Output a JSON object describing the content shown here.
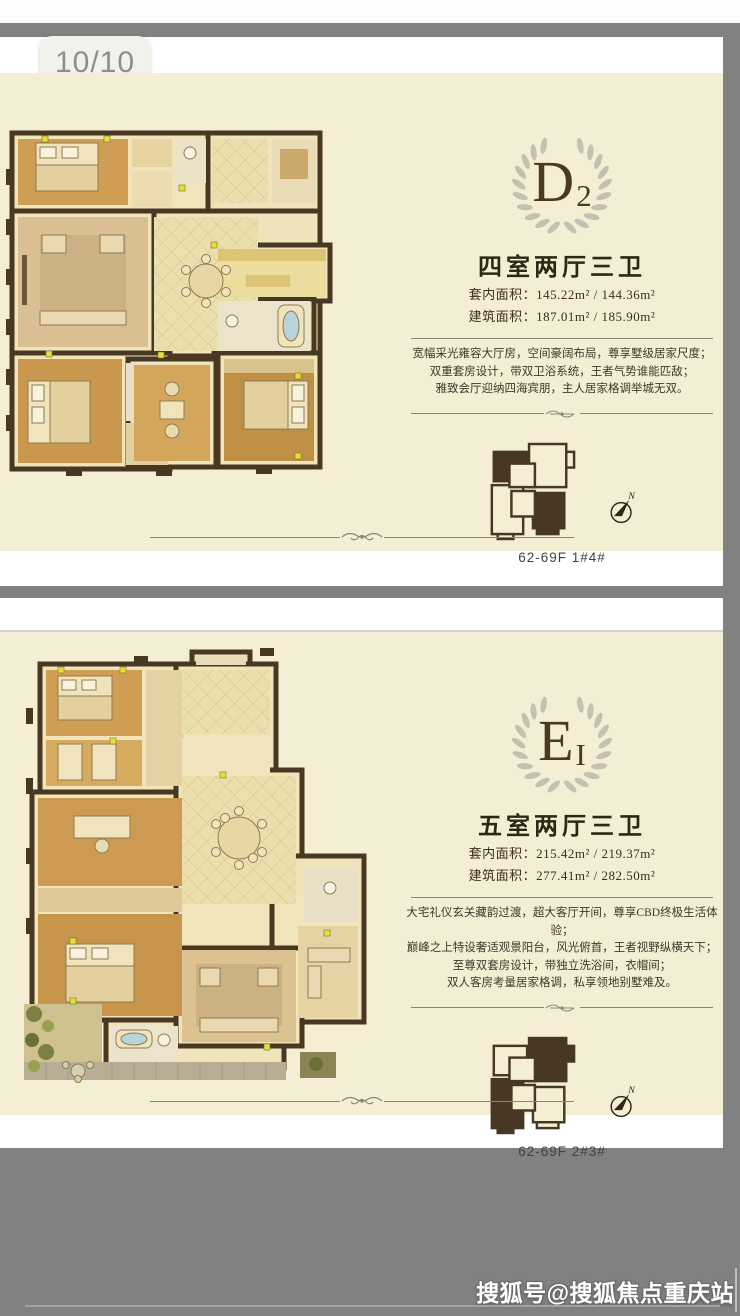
{
  "viewer": {
    "page_indicator": "10/10",
    "watermark": "搜狐号@搜狐焦点重庆站"
  },
  "plans": [
    {
      "monogram": "D",
      "monogram_sub": "2",
      "title": "四室两厅三卫",
      "area_lines": [
        "套内面积：145.22m² / 144.36m²",
        "建筑面积：187.01m² / 185.90m²"
      ],
      "desc_lines": [
        "宽幅采光雍容大厅房，空间豪阔布局，尊享墅级居家尺度；",
        "双重套房设计，带双卫浴系统，王者气势谁能匹敌；",
        "雅致会厅迎纳四海宾朋，主人居家格调举城无双。"
      ],
      "keyplan_label": "62-69F 1#4#",
      "compass_label": "N"
    },
    {
      "monogram": "E",
      "monogram_sub": "I",
      "title": "五室两厅三卫",
      "area_lines": [
        "套内面积：215.42m² / 219.37m²",
        "建筑面积：277.41m² / 282.50m²"
      ],
      "desc_lines": [
        "大宅礼仪玄关藏韵过渡，超大客厅开间，尊享CBD终极生活体验；",
        "巅峰之上特设奢适观景阳台，风光俯首，王者视野纵横天下；",
        "至尊双套房设计，带独立洗浴间，衣帽间；",
        "双人客房考量居家格调，私享领地别墅难及。"
      ],
      "keyplan_label": "62-69F 2#3#",
      "compass_label": "N"
    }
  ],
  "colors": {
    "card_cream": "#f4eed5",
    "viewer_gray": "#818181",
    "accent_dark_brown": "#483721",
    "wreath_gray": "#c2c1b2",
    "wood_floor": "#cf9e54",
    "tile_floor": "#ecdfae"
  }
}
